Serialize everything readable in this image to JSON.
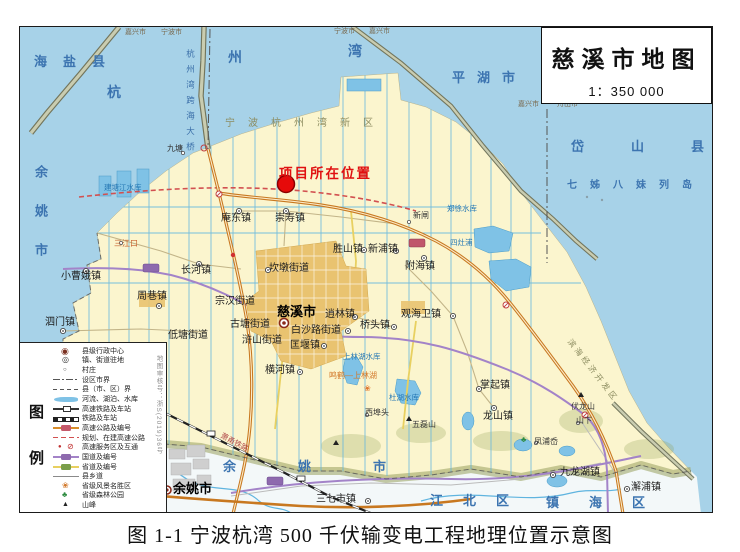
{
  "title_box": {
    "title": "慈溪市地图",
    "scale": "1：350 000"
  },
  "caption": "图 1-1 宁波杭湾 500 千伏输变电工程地理位置示意图",
  "project_marker": {
    "label": "项目所在位置"
  },
  "legend": {
    "big_chars": {
      "first": "图",
      "second": "例"
    },
    "review_no": "地图审核号：浙S(2019)36号",
    "items": [
      {
        "sym": "admin",
        "label": "县级行政中心"
      },
      {
        "sym": "town",
        "label": "镇、街道驻地"
      },
      {
        "sym": "village",
        "label": "村庄"
      },
      {
        "sym": "cityb",
        "label": "设区市界"
      },
      {
        "sym": "countyb",
        "label": "县（市、区）界"
      },
      {
        "sym": "river",
        "label": "河流、湖泊、水库"
      },
      {
        "sym": "hsr",
        "label": "高速铁路及车站"
      },
      {
        "sym": "rail",
        "label": "铁路及车站"
      },
      {
        "sym": "expwy",
        "label": "高速公路及编号"
      },
      {
        "sym": "planned",
        "label": "规划、在建高速公路"
      },
      {
        "sym": "service",
        "label": "高速服务区及互通"
      },
      {
        "sym": "national",
        "label": "国道及编号"
      },
      {
        "sym": "provincial",
        "label": "省道及编号"
      },
      {
        "sym": "croad",
        "label": "县乡道"
      },
      {
        "sym": "scenic",
        "label": "省级风景名胜区"
      },
      {
        "sym": "forest",
        "label": "省级森林公园"
      },
      {
        "sym": "peak",
        "label": "山峰"
      }
    ]
  },
  "map_labels": [
    {
      "t": "海盐县",
      "x": 33,
      "y": 54,
      "c": "sea-lg",
      "ls": 16
    },
    {
      "t": "杭",
      "x": 106,
      "y": 84,
      "c": "sea-ch"
    },
    {
      "t": "州",
      "x": 227,
      "y": 49,
      "c": "sea-ch"
    },
    {
      "t": "湾",
      "x": 347,
      "y": 43,
      "c": "sea-ch"
    },
    {
      "t": "平湖市",
      "x": 451,
      "y": 70,
      "c": "sea-lg",
      "ls": 12
    },
    {
      "t": "岱山县",
      "x": 570,
      "y": 139,
      "c": "sea-lg",
      "ls": 47
    },
    {
      "t": "七姊八妹列岛",
      "x": 566,
      "y": 180,
      "c": "sea-md",
      "ls": 13
    },
    {
      "t": "余姚市",
      "x": 33,
      "y": 164,
      "c": "sea-lg vert",
      "ls": 26
    },
    {
      "t": "余姚市",
      "x": 222,
      "y": 459,
      "c": "sea-lg",
      "ls": 62
    },
    {
      "t": "江北区",
      "x": 429,
      "y": 493,
      "c": "sea-lg",
      "ls": 20
    },
    {
      "t": "镇海区",
      "x": 545,
      "y": 495,
      "c": "sea-lg",
      "ls": 30
    },
    {
      "t": "嘉兴市",
      "x": 124,
      "y": 28,
      "c": "bnd"
    },
    {
      "t": "宁波市",
      "x": 160,
      "y": 28,
      "c": "bnd"
    },
    {
      "t": "宁波市",
      "x": 333,
      "y": 27,
      "c": "bnd"
    },
    {
      "t": "嘉兴市",
      "x": 368,
      "y": 27,
      "c": "bnd"
    },
    {
      "t": "嘉兴市",
      "x": 517,
      "y": 100,
      "c": "bnd"
    },
    {
      "t": "舟山市",
      "x": 556,
      "y": 100,
      "c": "bnd"
    },
    {
      "t": "宁波杭州湾新区",
      "x": 224,
      "y": 118,
      "c": "region",
      "ls": 13
    },
    {
      "t": "滨海经济开发区",
      "x": 571,
      "y": 337,
      "c": "region-sm",
      "rot": 52
    },
    {
      "t": "杭州湾跨海大桥",
      "x": 185,
      "y": 48,
      "c": "bridgel",
      "ls": 7
    },
    {
      "t": "庵东镇",
      "x": 220,
      "y": 213,
      "c": "town"
    },
    {
      "t": "崇寿镇",
      "x": 274,
      "y": 213,
      "c": "town"
    },
    {
      "t": "长河镇",
      "x": 180,
      "y": 265,
      "c": "town"
    },
    {
      "t": "周巷镇",
      "x": 136,
      "y": 291,
      "c": "town"
    },
    {
      "t": "小曹娥镇",
      "x": 60,
      "y": 271,
      "c": "town"
    },
    {
      "t": "泗门镇",
      "x": 44,
      "y": 317,
      "c": "town"
    },
    {
      "t": "低塘街道",
      "x": 167,
      "y": 330,
      "c": "town"
    },
    {
      "t": "坎墩街道",
      "x": 268,
      "y": 263,
      "c": "town"
    },
    {
      "t": "宗汉街道",
      "x": 214,
      "y": 296,
      "c": "town"
    },
    {
      "t": "慈溪市",
      "x": 276,
      "y": 304,
      "c": "city"
    },
    {
      "t": "古塘街道",
      "x": 229,
      "y": 319,
      "c": "town"
    },
    {
      "t": "白沙路街道",
      "x": 290,
      "y": 325,
      "c": "town"
    },
    {
      "t": "浒山街道",
      "x": 241,
      "y": 335,
      "c": "town"
    },
    {
      "t": "匡堰镇",
      "x": 289,
      "y": 340,
      "c": "town"
    },
    {
      "t": "逍林镇",
      "x": 324,
      "y": 309,
      "c": "town"
    },
    {
      "t": "桥头镇",
      "x": 359,
      "y": 320,
      "c": "town"
    },
    {
      "t": "横河镇",
      "x": 264,
      "y": 365,
      "c": "town"
    },
    {
      "t": "胜山镇",
      "x": 332,
      "y": 244,
      "c": "town"
    },
    {
      "t": "新浦镇",
      "x": 367,
      "y": 244,
      "c": "town"
    },
    {
      "t": "附海镇",
      "x": 404,
      "y": 261,
      "c": "town"
    },
    {
      "t": "观海卫镇",
      "x": 400,
      "y": 309,
      "c": "town"
    },
    {
      "t": "掌起镇",
      "x": 479,
      "y": 380,
      "c": "town"
    },
    {
      "t": "龙山镇",
      "x": 482,
      "y": 411,
      "c": "town"
    },
    {
      "t": "三七市镇",
      "x": 315,
      "y": 494,
      "c": "town"
    },
    {
      "t": "九龙湖镇",
      "x": 559,
      "y": 467,
      "c": "town"
    },
    {
      "t": "澥浦镇",
      "x": 630,
      "y": 482,
      "c": "town"
    },
    {
      "t": "余姚市",
      "x": 172,
      "y": 481,
      "c": "city"
    },
    {
      "t": "新闸",
      "x": 412,
      "y": 211,
      "c": "vil"
    },
    {
      "t": "九塘",
      "x": 166,
      "y": 144,
      "c": "vil"
    },
    {
      "t": "山下",
      "x": 575,
      "y": 416,
      "c": "vil"
    },
    {
      "t": "凤浦岙",
      "x": 533,
      "y": 437,
      "c": "vil"
    },
    {
      "t": "西埠头",
      "x": 364,
      "y": 408,
      "c": "vil"
    },
    {
      "t": "三江口",
      "x": 113,
      "y": 239,
      "c": "orange-sm"
    },
    {
      "t": "郑徐水库",
      "x": 446,
      "y": 204,
      "c": "water"
    },
    {
      "t": "四灶浦",
      "x": 449,
      "y": 238,
      "c": "water"
    },
    {
      "t": "上林湖水库",
      "x": 342,
      "y": 352,
      "c": "water"
    },
    {
      "t": "杜湖水库",
      "x": 388,
      "y": 393,
      "c": "water"
    },
    {
      "t": "建塘江水库",
      "x": 103,
      "y": 183,
      "c": "water"
    },
    {
      "t": "五磊山",
      "x": 411,
      "y": 420,
      "c": "peakl"
    },
    {
      "t": "伏龙山",
      "x": 570,
      "y": 402,
      "c": "peakl"
    },
    {
      "t": "鸣鹤—上林湖",
      "x": 328,
      "y": 371,
      "c": "scenic"
    },
    {
      "t": "萧甬铁路",
      "x": 222,
      "y": 431,
      "c": "raill",
      "rot": 28
    }
  ],
  "colors": {
    "sea": "#A7D2E8",
    "land": "#FBF5CE",
    "urban": "#E9C370",
    "hills": "#99A15F",
    "expressway": "#D98E2B",
    "national_road": "#A383C8",
    "provincial_road": "#E8D060",
    "canal": "#5FB4DF",
    "railway": "#222222",
    "project_red": "#E60A0A",
    "sea_text": "#3C74B0"
  }
}
